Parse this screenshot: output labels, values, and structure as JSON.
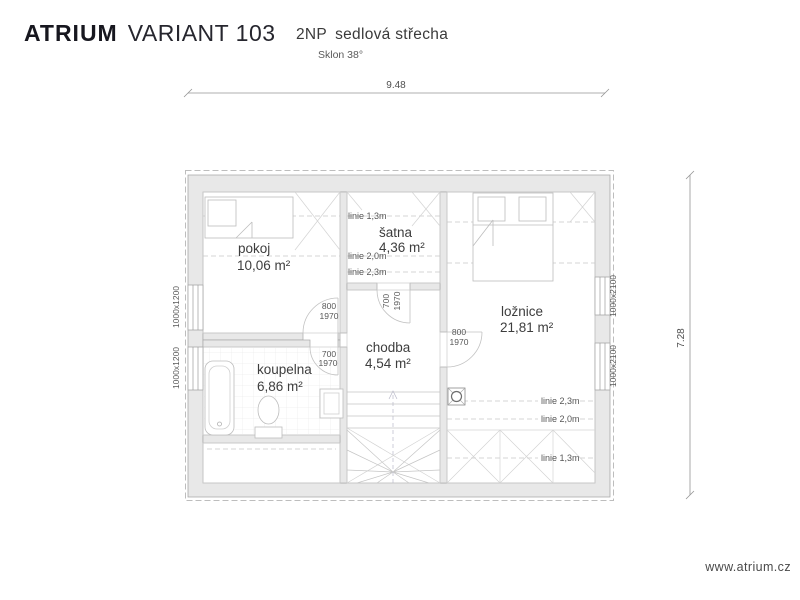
{
  "header": {
    "brand": "ATRIUM",
    "variant": "VARIANT 103",
    "floor": "2NP",
    "roof": "sedlová střecha",
    "slope": "Sklon 38°"
  },
  "dimensions": {
    "width": "9.48",
    "height": "7.28"
  },
  "rooms": {
    "pokoj": {
      "name": "pokoj",
      "area": "10,06 m²"
    },
    "satna": {
      "name": "šatna",
      "area": "4,36 m²"
    },
    "chodba": {
      "name": "chodba",
      "area": "4,54 m²"
    },
    "koupelna": {
      "name": "koupelna",
      "area": "6,86 m²"
    },
    "loznice": {
      "name": "ložnice",
      "area": "21,81 m²"
    }
  },
  "doors": {
    "pokoj": {
      "width": "800",
      "height": "1970"
    },
    "koupelna": {
      "width": "700",
      "height": "1970"
    },
    "satna": {
      "width": "700",
      "height": "1970"
    },
    "loznice": {
      "width": "800",
      "height": "1970"
    }
  },
  "windows": {
    "left_top": "1000x1200",
    "left_bottom": "1000x1200",
    "right_top": "1000x2100",
    "right_bottom": "1000x2100"
  },
  "height_lines": {
    "satna": [
      "linie 1,3m",
      "linie 2,0m",
      "linie 2,3m"
    ],
    "loznice": [
      "linie 2,3m",
      "linie 2,0m",
      "linie 1,3m"
    ]
  },
  "footer": {
    "website": "www.atrium.cz"
  },
  "colors": {
    "wall_fill": "#e8e8e8",
    "drawing_line": "#c6c6c6",
    "brand_text": "#17171f"
  }
}
